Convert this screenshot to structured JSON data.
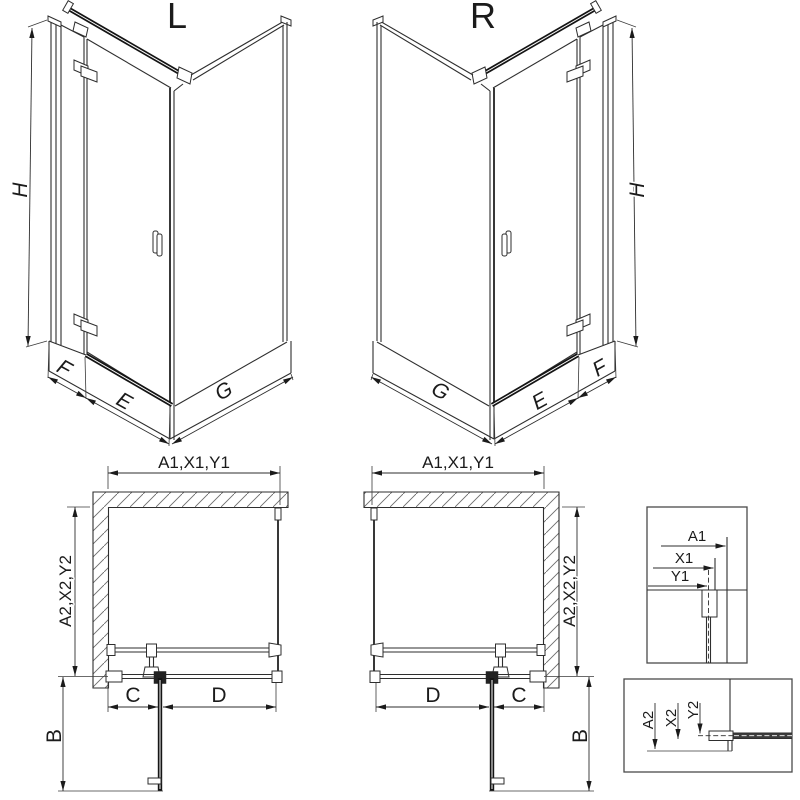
{
  "meta": {
    "background": "#ffffff",
    "ink_color": "#2e2e2e"
  },
  "views": {
    "iso_left": {
      "title": "L",
      "dim_height": "H",
      "dim_side_width": "F",
      "dim_door_width": "E",
      "dim_return_width": "G"
    },
    "iso_right": {
      "title": "R",
      "dim_height": "H",
      "dim_side_width": "F",
      "dim_door_width": "E",
      "dim_return_width": "G"
    },
    "plan_left": {
      "dim_width": "A1,X1,Y1",
      "dim_depth": "A2,X2,Y2",
      "dim_wall_to_hinge": "C",
      "dim_fixed_panel": "D",
      "dim_door_swing": "B"
    },
    "plan_right": {
      "dim_width": "A1,X1,Y1",
      "dim_depth": "A2,X2,Y2",
      "dim_wall_to_hinge": "C",
      "dim_fixed_panel": "D",
      "dim_door_swing": "B"
    },
    "detail_wall_profile": {
      "dim_total": "A1",
      "dim_profile": "X1",
      "dim_axis": "Y1"
    },
    "detail_floor_profile": {
      "dim_total": "A2",
      "dim_profile": "X2",
      "dim_axis": "Y2"
    }
  }
}
